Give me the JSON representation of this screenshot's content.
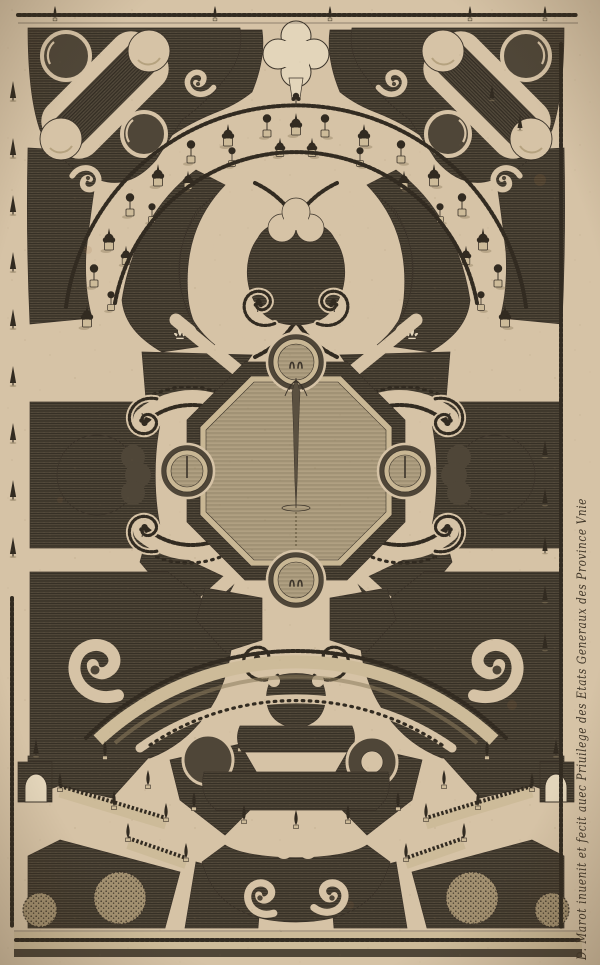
{
  "artwork": {
    "inscription": "D. Marot inuenit et fecit auec Priuilege des Etats Generaux des Province Vnie"
  },
  "palette": {
    "paper": "#d6c3a6",
    "paper_light": "#e3d5ba",
    "ink": "#3c342a",
    "bed": "#4f4638",
    "bed_line": "#2b251d",
    "hedge": "#322b21",
    "water": "#b4a486",
    "water_line": "#7e7055",
    "wall_face": "#cdbb99",
    "stone": "#c9b794",
    "shadow": "#8c7b5d"
  }
}
